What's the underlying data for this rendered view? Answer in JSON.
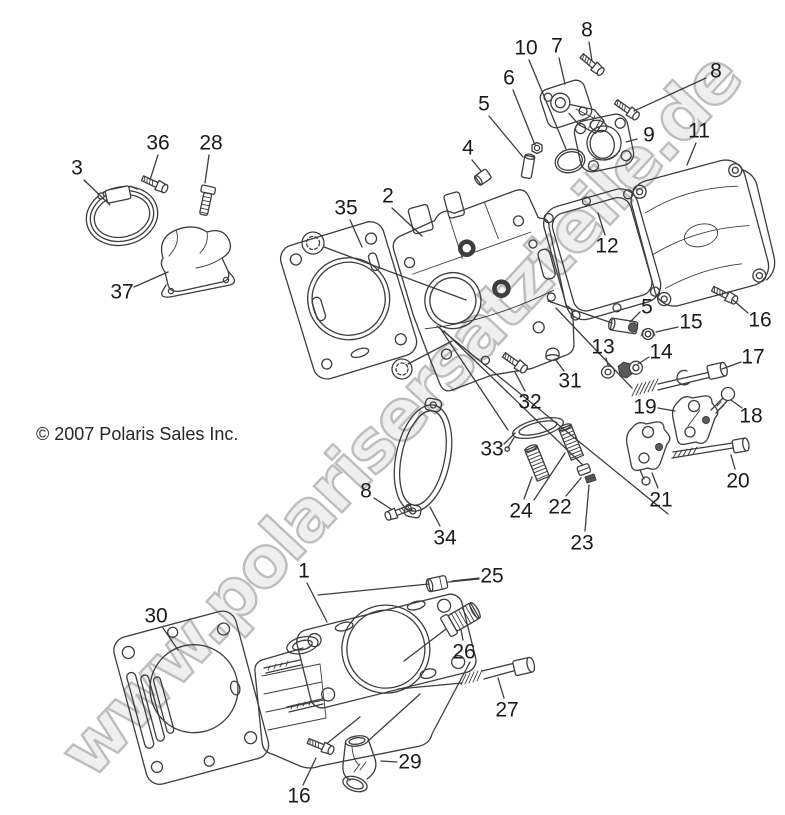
{
  "diagram": {
    "watermark": "www.polarisersatzteile.de",
    "copyright": "© 2007 Polaris Sales Inc.",
    "colors": {
      "background": "#ffffff",
      "line": "#3d3d3d",
      "label": "#1a1a1a",
      "watermark_fill": "#efefef",
      "watermark_stroke": "#bdbdbd"
    },
    "callouts": [
      {
        "n": "3",
        "x": 77,
        "y": 168,
        "leaders": [
          [
            84,
            180,
            110,
            205
          ]
        ]
      },
      {
        "n": "36",
        "x": 158,
        "y": 143,
        "leaders": [
          [
            158,
            155,
            150,
            180
          ]
        ]
      },
      {
        "n": "28",
        "x": 211,
        "y": 143,
        "leaders": [
          [
            209,
            155,
            205,
            183
          ]
        ]
      },
      {
        "n": "37",
        "x": 122,
        "y": 292,
        "leaders": [
          [
            134,
            287,
            168,
            272
          ]
        ]
      },
      {
        "n": "35",
        "x": 346,
        "y": 208,
        "leaders": [
          [
            350,
            220,
            362,
            247
          ]
        ]
      },
      {
        "n": "2",
        "x": 388,
        "y": 196,
        "leaders": [
          [
            392,
            208,
            422,
            236
          ]
        ]
      },
      {
        "n": "4",
        "x": 468,
        "y": 148,
        "leaders": [
          [
            472,
            160,
            481,
            171
          ]
        ]
      },
      {
        "n": "5",
        "x": 484,
        "y": 104,
        "leaders": [
          [
            489,
            116,
            523,
            157
          ]
        ]
      },
      {
        "n": "6",
        "x": 509,
        "y": 78,
        "leaders": [
          [
            513,
            90,
            535,
            145
          ]
        ]
      },
      {
        "n": "10",
        "x": 526,
        "y": 48,
        "leaders": [
          [
            529,
            60,
            566,
            149
          ]
        ]
      },
      {
        "n": "7",
        "x": 557,
        "y": 46,
        "leaders": [
          [
            559,
            58,
            565,
            84
          ]
        ]
      },
      {
        "n": "8",
        "x": 587,
        "y": 30,
        "leaders": [
          [
            589,
            42,
            592,
            61
          ]
        ]
      },
      {
        "n": "8",
        "x": 716,
        "y": 71,
        "leaders": [
          [
            706,
            78,
            634,
            111
          ]
        ]
      },
      {
        "n": "9",
        "x": 649,
        "y": 135,
        "leaders": [
          [
            637,
            139,
            626,
            142
          ]
        ]
      },
      {
        "n": "11",
        "x": 699,
        "y": 131,
        "leaders": [
          [
            696,
            143,
            687,
            165
          ]
        ]
      },
      {
        "n": "12",
        "x": 607,
        "y": 246,
        "leaders": [
          [
            605,
            235,
            598,
            213
          ]
        ]
      },
      {
        "n": "5",
        "x": 647,
        "y": 307,
        "leaders": [
          [
            640,
            312,
            630,
            322
          ]
        ]
      },
      {
        "n": "15",
        "x": 691,
        "y": 322,
        "leaders": [
          [
            678,
            327,
            656,
            332
          ]
        ]
      },
      {
        "n": "16",
        "x": 760,
        "y": 320,
        "leaders": [
          [
            748,
            313,
            733,
            300
          ]
        ]
      },
      {
        "n": "13",
        "x": 603,
        "y": 347,
        "leaders": [
          [
            606,
            358,
            608,
            365
          ]
        ]
      },
      {
        "n": "14",
        "x": 661,
        "y": 352,
        "leaders": [
          [
            649,
            357,
            638,
            364
          ]
        ]
      },
      {
        "n": "17",
        "x": 753,
        "y": 357,
        "leaders": [
          [
            741,
            362,
            722,
            369
          ]
        ]
      },
      {
        "n": "19",
        "x": 645,
        "y": 407,
        "leaders": [
          [
            658,
            408,
            675,
            411
          ]
        ]
      },
      {
        "n": "18",
        "x": 751,
        "y": 416,
        "leaders": [
          [
            742,
            408,
            731,
            400
          ]
        ]
      },
      {
        "n": "21",
        "x": 661,
        "y": 500,
        "leaders": [
          [
            658,
            488,
            652,
            473
          ]
        ]
      },
      {
        "n": "20",
        "x": 738,
        "y": 481,
        "leaders": [
          [
            735,
            469,
            731,
            455
          ]
        ]
      },
      {
        "n": "31",
        "x": 570,
        "y": 381,
        "leaders": [
          [
            564,
            371,
            555,
            359
          ]
        ]
      },
      {
        "n": "32",
        "x": 530,
        "y": 402,
        "leaders": [
          [
            525,
            391,
            515,
            372
          ]
        ]
      },
      {
        "n": "33",
        "x": 492,
        "y": 449,
        "leaders": [
          [
            504,
            444,
            515,
            433
          ]
        ]
      },
      {
        "n": "24",
        "x": 521,
        "y": 511,
        "leaders": [
          [
            524,
            499,
            532,
            477
          ],
          [
            534,
            500,
            565,
            453
          ]
        ]
      },
      {
        "n": "22",
        "x": 560,
        "y": 507,
        "leaders": [
          [
            566,
            496,
            581,
            478
          ]
        ]
      },
      {
        "n": "23",
        "x": 582,
        "y": 543,
        "leaders": [
          [
            585,
            531,
            589,
            485
          ]
        ]
      },
      {
        "n": "34",
        "x": 445,
        "y": 538,
        "leaders": [
          [
            440,
            526,
            430,
            507
          ]
        ]
      },
      {
        "n": "8",
        "x": 366,
        "y": 491,
        "leaders": [
          [
            374,
            498,
            391,
            509
          ]
        ]
      },
      {
        "n": "25",
        "x": 492,
        "y": 576,
        "leaders": [
          [
            479,
            578,
            452,
            581
          ]
        ]
      },
      {
        "n": "26",
        "x": 464,
        "y": 652,
        "leaders": [
          [
            463,
            640,
            461,
            630
          ]
        ]
      },
      {
        "n": "27",
        "x": 507,
        "y": 710,
        "leaders": [
          [
            504,
            698,
            498,
            678
          ]
        ]
      },
      {
        "n": "29",
        "x": 410,
        "y": 762,
        "leaders": [
          [
            397,
            762,
            381,
            761
          ]
        ]
      },
      {
        "n": "30",
        "x": 156,
        "y": 616,
        "leaders": [
          [
            163,
            628,
            178,
            650
          ]
        ]
      },
      {
        "n": "1",
        "x": 304,
        "y": 571,
        "leaders": [
          [
            307,
            583,
            327,
            622
          ]
        ]
      },
      {
        "n": "16",
        "x": 299,
        "y": 796,
        "leaders": [
          [
            303,
            785,
            316,
            758
          ]
        ]
      }
    ]
  }
}
